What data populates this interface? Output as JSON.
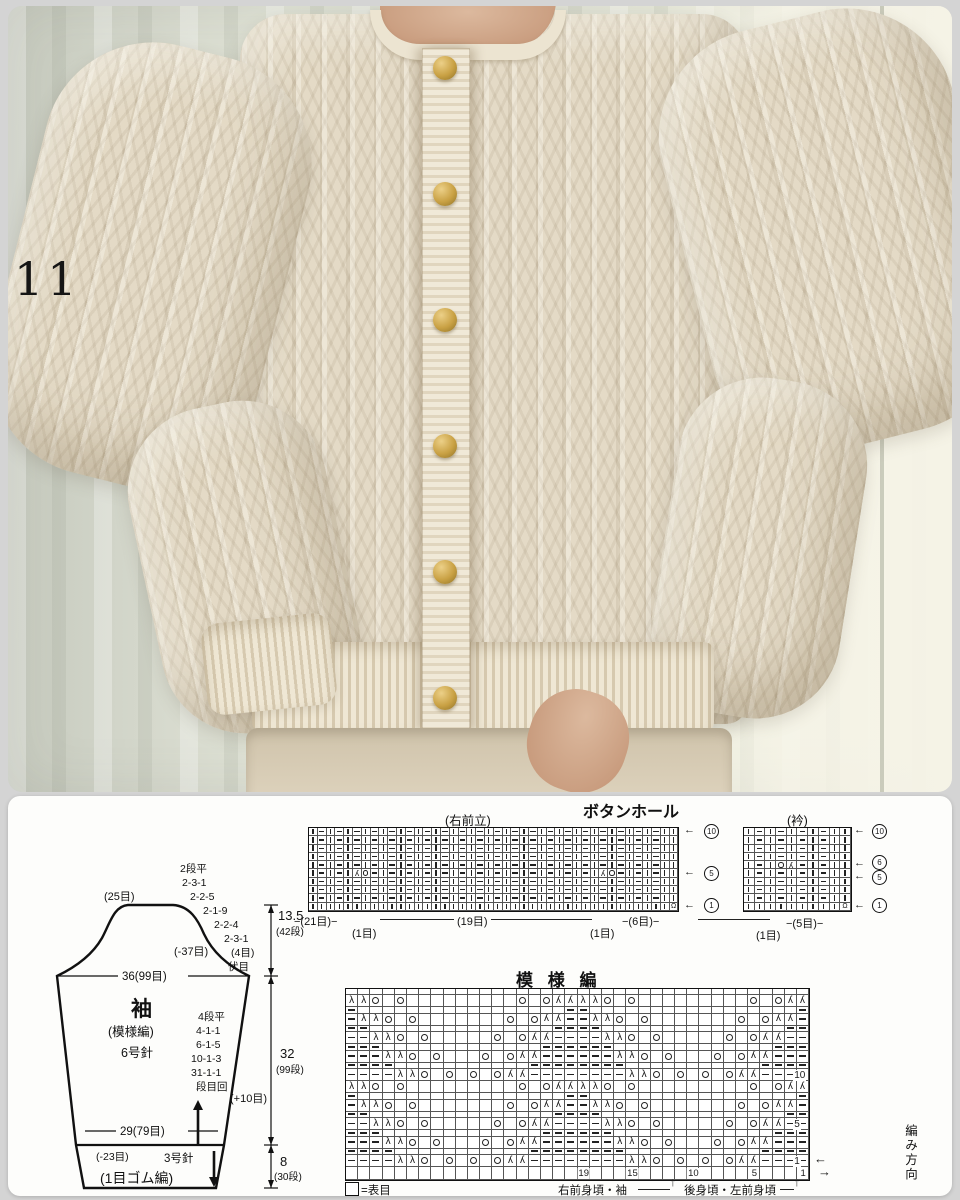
{
  "photo": {
    "label": "11"
  },
  "buttonhole_chart": {
    "title": "ボタンホール",
    "band_label": "(右前立)",
    "row_markers": [
      "10",
      "5",
      "1"
    ],
    "stitch_labels": [
      "−(21目)−",
      "(1目)",
      "(19目)",
      "(1目)",
      "−(6目)−"
    ],
    "rows": [
      "|-|-|-|-|-|-|-|-|-|-|-|-|-|-|-|-|-|-|-|-||",
      "|-|-|-|-|-|-|-|-|-|-|-|-|-|-|-|-|-|-|-|-||",
      "|-|-|-|-|-|-|-|-|-|-|-|-|-|-|-|-|-|-|-|-||",
      "|-|-|-|-|-|-|-|-|-|-|-|-|-|-|-|-|-|-|-|-||",
      "|-|-|-|-|-|-|-|-|-|-|-|-|-|-|-|-|-|-|-|-||",
      "|-|-|Ro-|-|-|-|-|-|-|-|-|-|-|-|-|Ro-|-|-||",
      "|-|-|-|-|-|-|-|-|-|-|-|-|-|-|-|-|-|-|-|-||",
      "|-|-|-|-|-|-|-|-|-|-|-|-|-|-|-|-|-|-|-|-||",
      "|-|-|-|-|-|-|-|-|-|-|-|-|-|-|-|-|-|-|-|-||",
      "|||||||||||||||||||||||||||||||||||||||||Q"
    ]
  },
  "collar_chart": {
    "title": "(衿)",
    "row_markers": [
      "10",
      "6",
      "5",
      "1"
    ],
    "stitch_labels": [
      "(1目)",
      "−(5目)−"
    ],
    "rows": [
      "|-|-|-|-||",
      "|-|-|-|-||",
      "|-|-|-|-||",
      "|-|-|-|-||",
      "|-|oR-|-||",
      "|-|-|-|-||",
      "|-|-|-|-||",
      "|-|-|-|-||",
      "|-|-|-|-||",
      "|||||||||Q"
    ]
  },
  "pattern_chart": {
    "title": "模 様 編",
    "repeat": 2,
    "row_patterns": {
      "T0": "LLo.o.........o.oRR",
      "T1": "-LLo.o.......o.oRR-",
      "T2": "--LLo.o.....o.oRR--",
      "T3": "---LLo.o...o.oRR---",
      "T4": "----LLo.o.o.oRR----",
      "S0": "-.................-",
      "S1": "--...............--",
      "S2": "---.............---",
      "S3": "----...........----",
      "E": "...................",
      "D": "..................."
    },
    "sequence": [
      "E",
      "T0",
      "S0",
      "T1",
      "S1",
      "T2",
      "S2",
      "T3",
      "S3",
      "T4",
      "T0",
      "S0",
      "T1",
      "S1",
      "T2",
      "S2",
      "T3",
      "S3",
      "T4",
      "D"
    ],
    "row_number_at": {
      "9": "10",
      "14": "5",
      "18": "1"
    },
    "stitch_numbers": [
      {
        "label": "19",
        "col": 20
      },
      {
        "label": "15",
        "col": 24
      },
      {
        "label": "10",
        "col": 29
      },
      {
        "label": "5",
        "col": 34
      },
      {
        "label": "1",
        "col": 38
      }
    ],
    "direction_label": "編み方向",
    "dir_arrow_left": "←",
    "dir_arrow_right": "→",
    "legend_text": "=表目",
    "footer_left": "右前身頃・袖",
    "footer_right": "後身頃・左前身頃",
    "footer_arrow": "↑"
  },
  "sleeve": {
    "name": "袖",
    "stitch_note": "(模様編)",
    "needle": "6号針",
    "top_stitches": "(25目)",
    "cap_decreases": [
      "2段平",
      "2-3-1",
      "2-2-5",
      "2-1-9",
      "2-2-4",
      "2-3-1",
      "(4目)",
      "伏目"
    ],
    "cap_total_dec": "(-37目)",
    "underarm_width": "36(99目)",
    "increases": [
      "4段平",
      "4-1-1",
      "6-1-5",
      "10-1-3",
      "31-1-1",
      "段目回"
    ],
    "cuff_top_width": "29(79目)",
    "cuff_decrease": "(-23目)",
    "cuff_needle": "3号針",
    "cuff_stitch": "(1目ゴム編)",
    "plus_stitches": "(+10目)",
    "dim_cap": "13.5",
    "dim_cap_rows": "(42段)",
    "dim_body": "32",
    "dim_body_rows": "(99段)",
    "dim_cuff": "8",
    "dim_cuff_rows": "(30段)"
  }
}
